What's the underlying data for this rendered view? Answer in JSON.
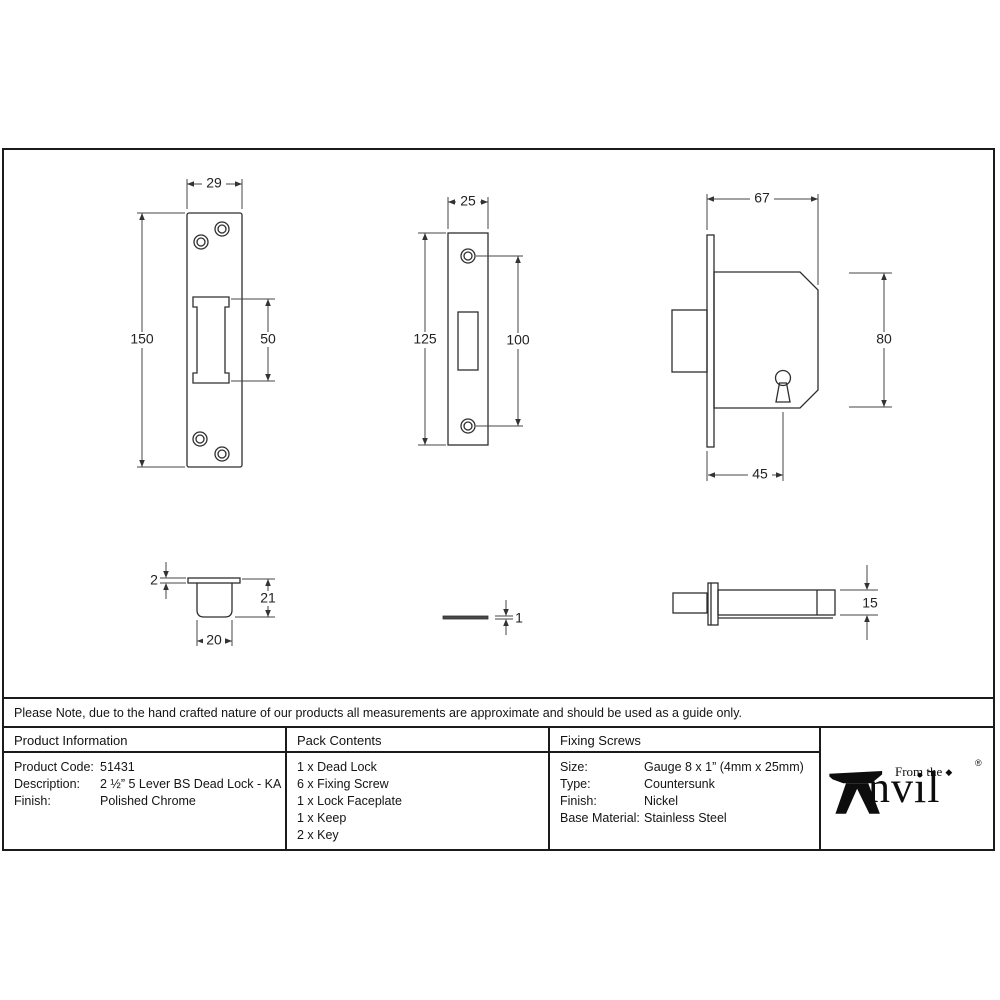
{
  "note": "Please Note, due to the hand crafted nature of our products all measurements are approximate and should be used as a guide only.",
  "dimensions": {
    "keep_width": "29",
    "keep_height": "150",
    "keep_cutout": "50",
    "faceplate_width": "25",
    "faceplate_height": "125",
    "faceplate_holes": "100",
    "case_width": "67",
    "case_height": "80",
    "case_backset": "45",
    "cup_flange": "2",
    "cup_depth": "21",
    "cup_width": "20",
    "plate_thickness": "1",
    "case_depth": "15"
  },
  "product_information": {
    "header": "Product Information",
    "rows": [
      {
        "label": "Product Code:",
        "value": "51431"
      },
      {
        "label": "Description:",
        "value": "2 ½” 5 Lever BS Dead Lock - KA"
      },
      {
        "label": "Finish:",
        "value": "Polished Chrome"
      }
    ]
  },
  "pack_contents": {
    "header": "Pack Contents",
    "items": [
      "1 x Dead Lock",
      "6 x Fixing Screw",
      "1 x Lock Faceplate",
      "1 x Keep",
      "2 x Key"
    ]
  },
  "fixing_screws": {
    "header": "Fixing Screws",
    "rows": [
      {
        "label": "Size:",
        "value": "Gauge 8 x 1” (4mm x 25mm)"
      },
      {
        "label": "Type:",
        "value": "Countersunk"
      },
      {
        "label": "Finish:",
        "value": "Nickel"
      },
      {
        "label": "Base Material:",
        "value": "Stainless Steel"
      }
    ]
  },
  "brand": {
    "prefix": "From the",
    "diamond": "◆",
    "name_suffix": "nvil",
    "registered": "®"
  }
}
